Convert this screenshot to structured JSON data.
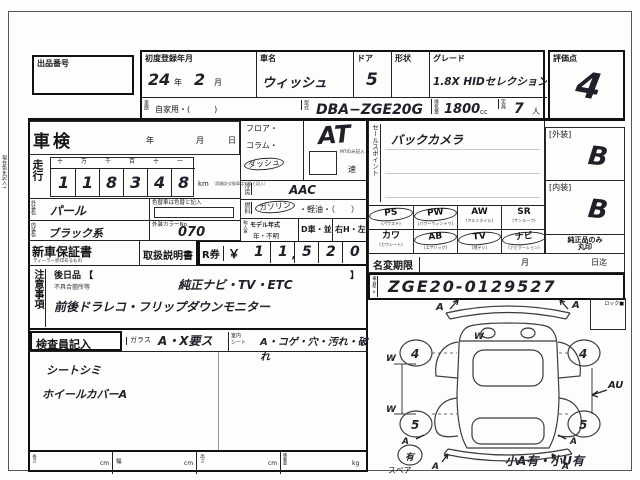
{
  "header": {
    "auction_no_label": "出品番号",
    "first_reg_label": "初度登録年月",
    "first_reg_year": "24",
    "year_suffix": "年",
    "first_reg_month": "2",
    "month_suffix": "月",
    "car_name_label": "車名",
    "car_name_value": "ウィッシュ",
    "door_label": "ドア",
    "door_value": "5",
    "shape_label": "形状",
    "shape_value": "",
    "grade_label": "グレード",
    "grade_value": "1.8X HIDセレクション",
    "score_label": "評価点",
    "score_value": "4",
    "history_label": "車歴",
    "history_value": "自家用・(　　　)",
    "model_code_label": "型式",
    "model_code_value": "DBA−ZGE20G",
    "disp_label": "排気量",
    "disp_value": "1800",
    "disp_unit": "cc",
    "capacity_label": "定員",
    "capacity_value": "7",
    "capacity_unit": "人"
  },
  "left": {
    "margin_note": "現在色を記入→",
    "shaken_label": "車検",
    "year_label": "年",
    "month_label": "月",
    "day_label": "日",
    "mileage_label": "走行",
    "digit_headers": [
      "十",
      "万",
      "千",
      "百",
      "十",
      "一"
    ],
    "digits": [
      "1",
      "1",
      "8",
      "3",
      "4",
      "8"
    ],
    "km_label": "km",
    "km_note": "（距離計交換車は交換と記入）",
    "color_change_note": "色替車は色替と記入",
    "ext_color_label": "外装色",
    "ext_color_value": "パール",
    "ext_color_no_label": "外装カラーNo.",
    "ext_color_no_value": "070",
    "int_color_label": "内装色",
    "int_color_value": "ブラック系",
    "warranty_label": "新車保証書",
    "warranty_note": "ディーラー捺印あるもの",
    "manual_label": "取扱説明書",
    "r_ticket_label": "R券",
    "yen_label": "￥",
    "r_comma": ",",
    "r_digits": [
      "1",
      "1",
      "5",
      "2",
      "0"
    ],
    "notes_label": "注意事項",
    "later_label": "後日品 【",
    "bracket_close": "】",
    "defect_label": "不具合箇所等",
    "note_line1": "純正ナビ・TV・ETC",
    "note_line2": "前後ドラレコ・フリップダウンモニター"
  },
  "middle": {
    "shift_opt1": "フロア・",
    "shift_opt2": "コラム・",
    "shift_opt3": "ダッシュ",
    "at_value": "AT",
    "mt_note": "MTのみ記入",
    "speed_label": "速",
    "ac_label": "冷房",
    "ac_value": "AAC",
    "fuel_label": "燃料",
    "fuel_opt1": "ガソリン",
    "fuel_opt2": "・軽油・（　　）",
    "import_label": "輸入車",
    "model_year_label": "モデル年式",
    "model_year_opts": "年・不明",
    "d_car_label": "D車・並",
    "handle_label": "右H・左H"
  },
  "right": {
    "sales_label": "セールスポイント",
    "sales_value": "バックカメラ",
    "equip1": [
      {
        "code": "PS",
        "name": "(パワステ)",
        "circled": true
      },
      {
        "code": "PW",
        "name": "(パワーウィンドウ)",
        "circled": true
      },
      {
        "code": "AW",
        "name": "(アルミホイル)",
        "circled": false
      },
      {
        "code": "SR",
        "name": "(サンルーフ)",
        "circled": false
      }
    ],
    "equip2": [
      {
        "code": "カワ",
        "name": "(カワシート)",
        "circled": false
      },
      {
        "code": "AB",
        "name": "(エアバッグ)",
        "circled": true
      },
      {
        "code": "TV",
        "name": "(地デジ)",
        "circled": true
      },
      {
        "code": "ナビ",
        "name": "(ナビゲーション)",
        "circled": true
      }
    ],
    "genuine_note1": "純正品のみ",
    "genuine_note2": "丸印",
    "name_change_label": "名変期限",
    "month_label": "月",
    "until_label": "日迄",
    "chassis_label": "車台No.",
    "chassis_value": "ZGE20-0129527",
    "ext_grade_label": "[外装]",
    "ext_grade_value": "B",
    "int_grade_label": "[内装]",
    "int_grade_value": "B"
  },
  "inspector": {
    "label": "検査員記入",
    "glass_label": "ガラス",
    "glass_opts": "A・X要ス",
    "seat_label1": "室内",
    "seat_label2": "シート",
    "seat_opts": "A・コゲ・穴・汚れ・破れ",
    "hw1": "シートシミ",
    "hw2": "ホイールカバーA"
  },
  "measure": {
    "len_label": "長さ",
    "cm1": "cm",
    "wid_label": "幅",
    "cm2": "cm",
    "hei_label": "高さ",
    "cm3": "cm",
    "load_label": "積載量",
    "kg": "kg"
  },
  "diagram": {
    "lock_label": "ロック■",
    "spare_label": "スペア",
    "spare_value": "有",
    "note": "小A有・小U有",
    "front_left_wheel": "4",
    "front_right_wheel": "4",
    "rear_left_wheel": "5",
    "rear_right_wheel": "5",
    "hood_mark": "W",
    "left_mark1": "W",
    "left_mark2": "W",
    "right_mark": "AU",
    "corner_mark": "A"
  }
}
